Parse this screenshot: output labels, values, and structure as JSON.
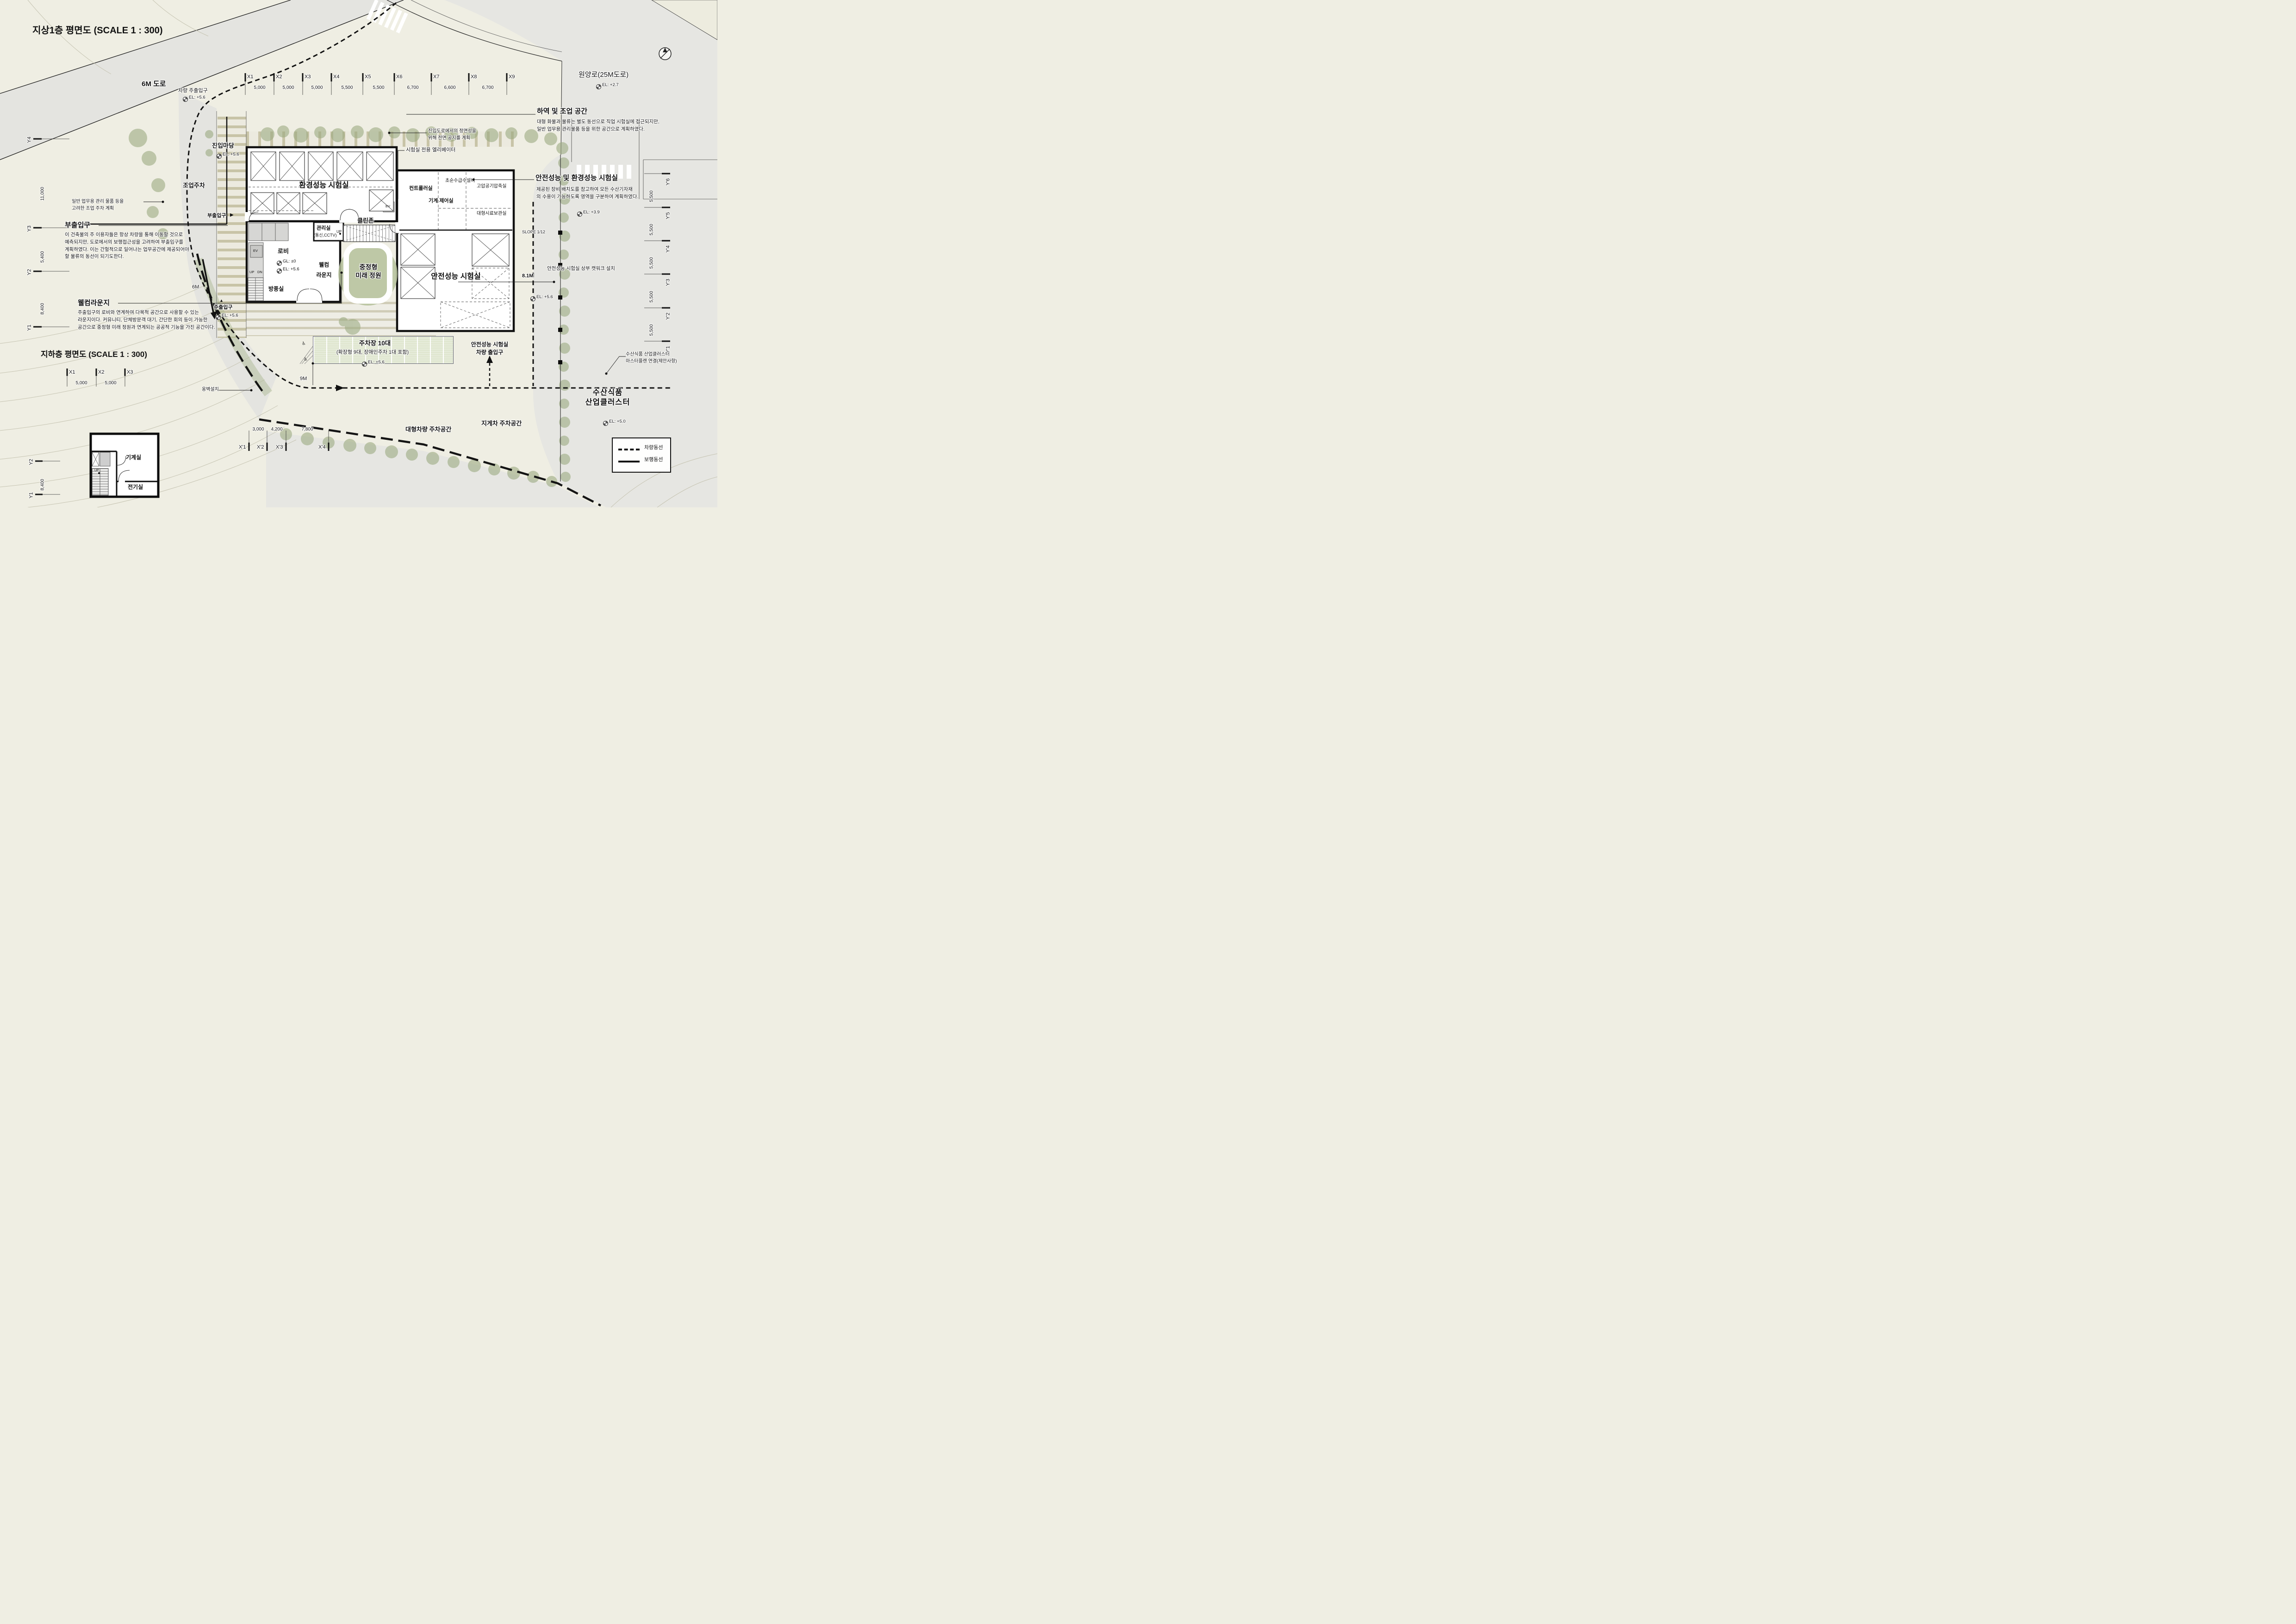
{
  "title": "지상1층 평면도 (SCALE 1 : 300)",
  "roads": {
    "road6m": "6M 도로",
    "vehicle_entry": "차량 주출입구",
    "vehicle_entry_el": "EL: +5.6",
    "wonyang": "원양로(25M도로)",
    "wonyang_el": "EL: +2.7"
  },
  "grid": {
    "x": [
      "X1",
      "X2",
      "X3",
      "X4",
      "X5",
      "X6",
      "X7",
      "X8",
      "X9"
    ],
    "x_dims": [
      "5,000",
      "5,000",
      "5,000",
      "5,500",
      "5,500",
      "6,700",
      "6,600",
      "6,700"
    ],
    "y": [
      "Y4",
      "Y3",
      "Y2",
      "Y1"
    ],
    "y_dims": [
      "11,000",
      "5,400",
      "8,400"
    ],
    "y_right": [
      "Y'6",
      "Y'5",
      "Y'4",
      "Y'3",
      "Y'2",
      "Y'1"
    ],
    "y_right_dims": [
      "5,500",
      "5,500",
      "5,500",
      "5,500",
      "5,500"
    ],
    "x_prime": [
      "X'1",
      "X'2",
      "X'3",
      "X'4"
    ],
    "x_prime_dims": [
      "3,000",
      "4,200",
      "7,800"
    ]
  },
  "rooms": {
    "env_lab": "환경성능 시험실",
    "controller": "컨트롤러실",
    "machine_control": "기계 제어실",
    "ultrapure": "초순수급수설비",
    "compressor": "고압공기압축실",
    "sample_storage": "대형시료보관실",
    "safety_lab": "안전성능 시험실",
    "cleanzone": "클린존",
    "office": "관리실",
    "office_sub": "(통신,CCTV)",
    "lobby": "로비",
    "lobby_gl": "GL: ±0",
    "lobby_el": "EL: +5.6",
    "welcome1": "웰컴",
    "welcome2": "라운지",
    "windbreak": "방풍실",
    "courtyard": "중정형\n미래 정원",
    "ev": "EV",
    "up": "UP",
    "dn": "DN"
  },
  "annotations": {
    "madang": "진입마당",
    "madang_el": "EL: +5.6",
    "jooeop": "조업주차",
    "note_parking": "일반 업무용 관리 물품 등을\n고려한 조업 주차 계획",
    "note_front": "진입도로에서의 정면성을\n위해 전면 공지를 계획",
    "note_elev": "시험실 전용 엘리베이터",
    "buchul_small": "부출입구",
    "buchul_arrow": "▶",
    "haeyok_title": "하역 및 조업 공간",
    "haeyok_body": "대형 화물과 물류는 별도 동선으로 직업 시험실에 접근되지만,\n일반 업무용 관리물품 등을 위한 공간으로 계획하였다.",
    "safety_env_title": "안전성능 및 환경성능 시험실",
    "safety_env_body": "제공된 장비 배치도를 참고하여 모든 수산기자재\n의 수용이 가능하도록 영역을 구분하여 계획하였다.",
    "buchul_title": "부출입구",
    "buchul_body": "이 건축물의 주 이용자들은 항상 차량을 통해 이동할 것으로\n예측되지만, 도로에서의 보행접근성을 고려하여 부출입구를\n계획하였다. 이는 간헐적으로 일어나는 업무공간에 제공되어야\n할 물류의 동선이 되기도한다.",
    "welcome_title": "웰컴라운지",
    "welcome_body": "주출입구의 로비와 연계하여 다목적 공간으로 사용할 수 있는\n라운지이다. 커뮤니티, 단체방문객 대기, 간단한 회의 등이 가능한\n공간으로 중정형 미래 정원과 연계되는 공공적 기능을 가진 공간이다.",
    "main_entry": "주출입구",
    "main_entry_el": "EL: +5.6",
    "entry_marker": "▲",
    "six_m": "6M",
    "nine_m": "9M",
    "slope": "SLOPE 1/12",
    "catwalk": "안전성능 시험실 상부 캣워크 설치",
    "m81": "8.1M",
    "el_56_right": "EL: +5.6",
    "el_39": "EL: +3.9",
    "safety_vehicle": "안전성능 시험실\n차량 출입구",
    "parking_title": "주차장 10대",
    "parking_sub": "(확장형 9대, 장애인주차 1대 포함)",
    "parking_el": "EL: +5.6",
    "accessible_icon": "♿",
    "ongbyeok": "옹벽설치",
    "large_vehicle": "대형차량 주차공간",
    "forklift": "지게차 주차공간",
    "cluster_note": "수산식품 산업클러스터\n마스터플랜 연결(제안사항)",
    "cluster_big": "수산식품\n산업클러스터",
    "el_50": "EL: +5.0"
  },
  "basement": {
    "title": "지하층 평면도 (SCALE 1 : 300)",
    "machine": "기계실",
    "electric": "전기실",
    "up": "UP",
    "grid_x": [
      "X1",
      "X2",
      "X3"
    ],
    "grid_x_dims": [
      "5,000",
      "5,000"
    ],
    "grid_y": [
      "Y2",
      "Y1"
    ],
    "grid_y_dims": [
      "8,400"
    ]
  },
  "legend": {
    "vehicle": "차량동선",
    "pedestrian": "보행동선"
  },
  "colors": {
    "paper": "#efeee3",
    "road_gray": "#e4e4e0",
    "tree_green": "#9cab82",
    "parking_green": "#dfe6cf",
    "wall": "#111111"
  }
}
